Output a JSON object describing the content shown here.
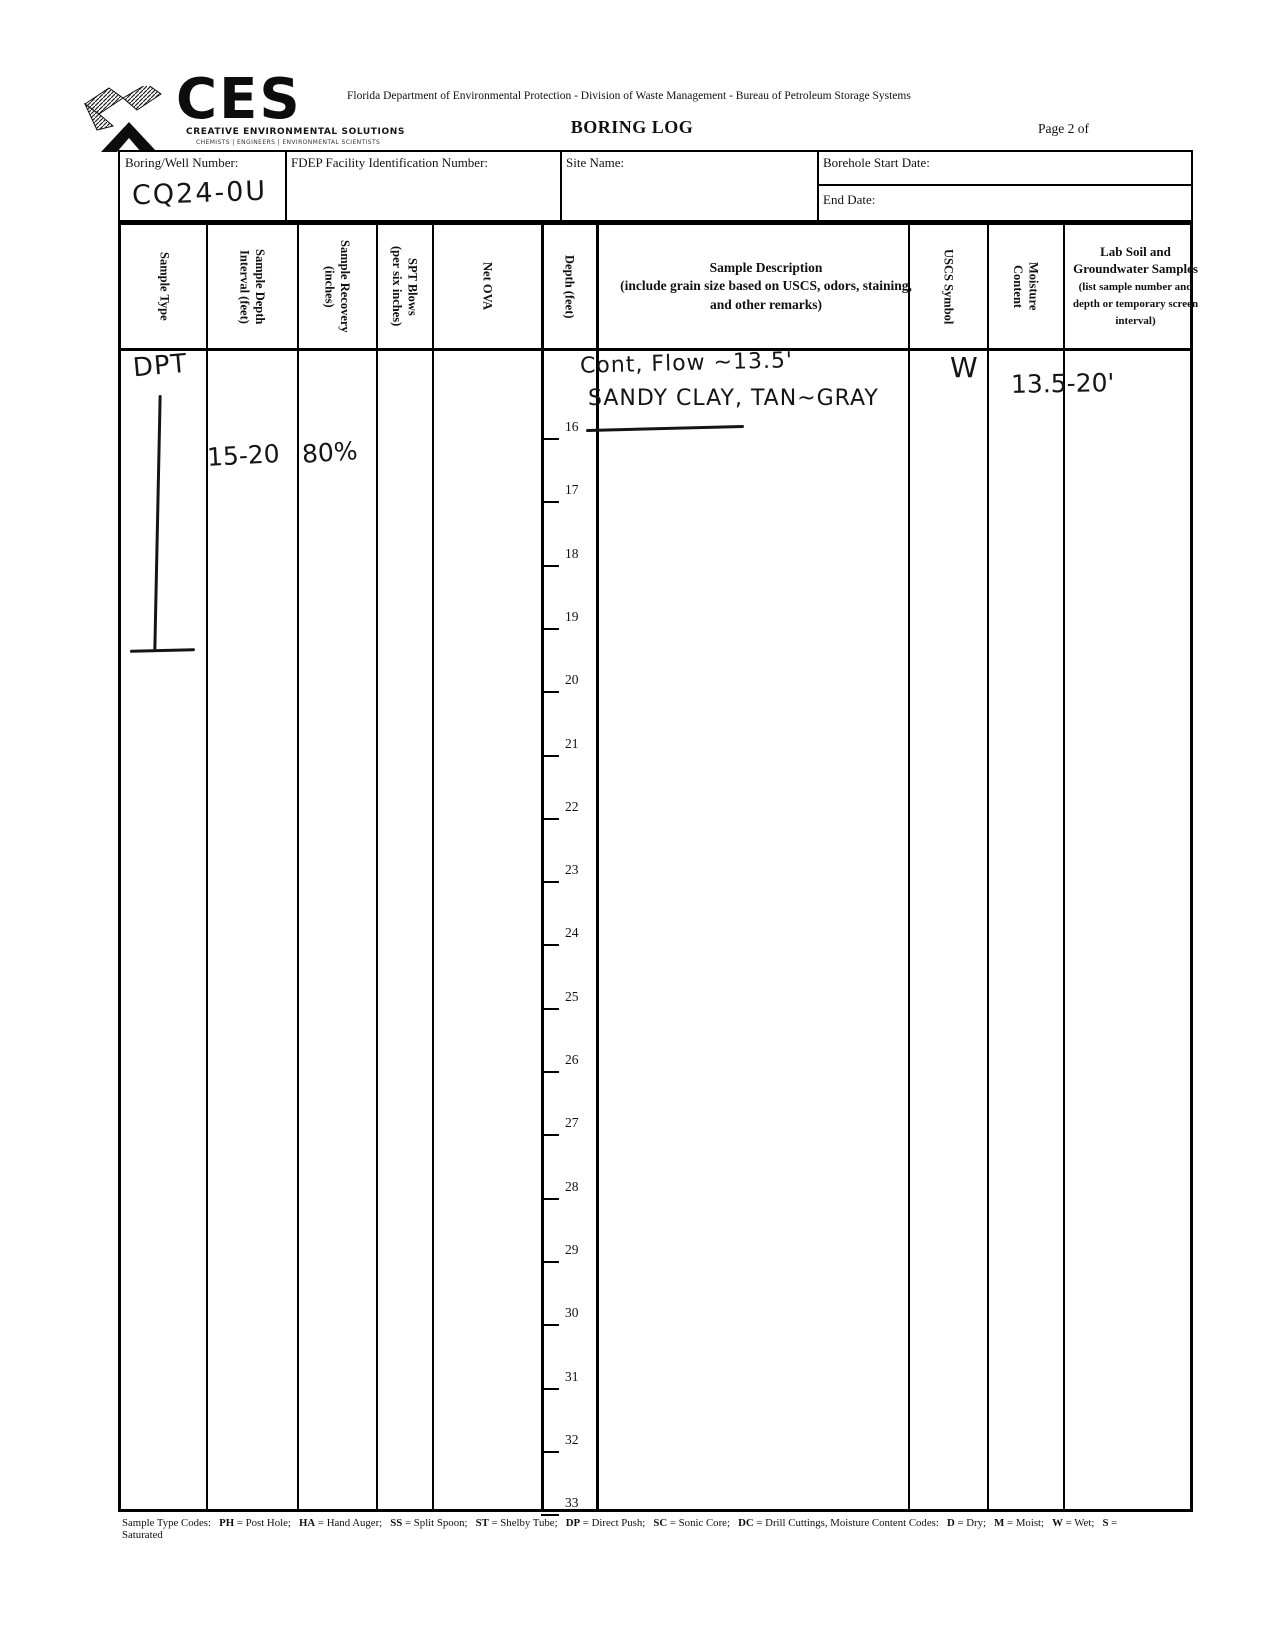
{
  "logo": {
    "acronym": "CES",
    "company_name": "CREATIVE ENVIRONMENTAL SOLUTIONS",
    "tagline": "CHEMISTS | ENGINEERS | ENVIRONMENTAL SCIENTISTS"
  },
  "header": {
    "agency_line": "Florida Department of Environmental Protection - Division of Waste Management - Bureau of Petroleum Storage Systems",
    "form_title": "BORING LOG",
    "page_label": "Page 2 of"
  },
  "info_fields": {
    "boring_well_label": "Boring/Well Number:",
    "boring_well_value": "CQ24-0U",
    "fdep_id_label": "FDEP Facility Identification Number:",
    "fdep_id_value": "",
    "site_name_label": "Site Name:",
    "site_name_value": "",
    "borehole_start_label": "Borehole Start Date:",
    "borehole_start_value": "",
    "end_date_label": "End Date:",
    "end_date_value": ""
  },
  "table": {
    "columns": [
      {
        "label": "Sample Type"
      },
      {
        "label": "Sample Depth\nInterval (feet)"
      },
      {
        "label": "Sample Recovery\n(inches)"
      },
      {
        "label": "SPT Blows\n(per six inches)"
      },
      {
        "label": "Net OVA"
      },
      {
        "label": "Depth (feet)"
      },
      {
        "title": "Sample Description",
        "note": "(include grain size based on USCS, odors, staining, and other remarks)"
      },
      {
        "label": "USCS Symbol"
      },
      {
        "label": "Moisture\nContent"
      },
      {
        "title": "Lab Soil and Groundwater Samples",
        "note": "(list sample number and depth or temporary screen interval)"
      }
    ]
  },
  "log_entry": {
    "sample_type": "DPT",
    "sample_depth_interval": "15-20",
    "sample_recovery": "80%",
    "spt_blows": "",
    "net_ova": "",
    "description_line1": "Cont, Flow ~13.5'",
    "description_soil": "SANDY CLAY",
    "description_rest": ", TAN~GRAY",
    "uscs_symbol": "",
    "moisture_content": "W",
    "lab_sample_interval": "13.5-20'"
  },
  "depth_scale": {
    "unit": "feet",
    "values": [
      16,
      17,
      18,
      19,
      20,
      21,
      22,
      23,
      24,
      25,
      26,
      27,
      28,
      29,
      30,
      31,
      32,
      33
    ]
  },
  "footer": {
    "sample_type_codes_label": "Sample Type Codes:",
    "sample_type_codes": [
      {
        "code": "PH",
        "meaning": "Post Hole"
      },
      {
        "code": "HA",
        "meaning": "Hand Auger"
      },
      {
        "code": "SS",
        "meaning": "Split Spoon"
      },
      {
        "code": "ST",
        "meaning": "Shelby Tube"
      },
      {
        "code": "DP",
        "meaning": "Direct Push"
      },
      {
        "code": "SC",
        "meaning": "Sonic Core"
      },
      {
        "code": "DC",
        "meaning": "Drill Cuttings"
      }
    ],
    "moisture_codes_label": "Moisture Content Codes:",
    "moisture_codes": [
      {
        "code": "D",
        "meaning": "Dry"
      },
      {
        "code": "M",
        "meaning": "Moist"
      },
      {
        "code": "W",
        "meaning": "Wet"
      },
      {
        "code": "S",
        "meaning": "Saturated"
      }
    ]
  }
}
